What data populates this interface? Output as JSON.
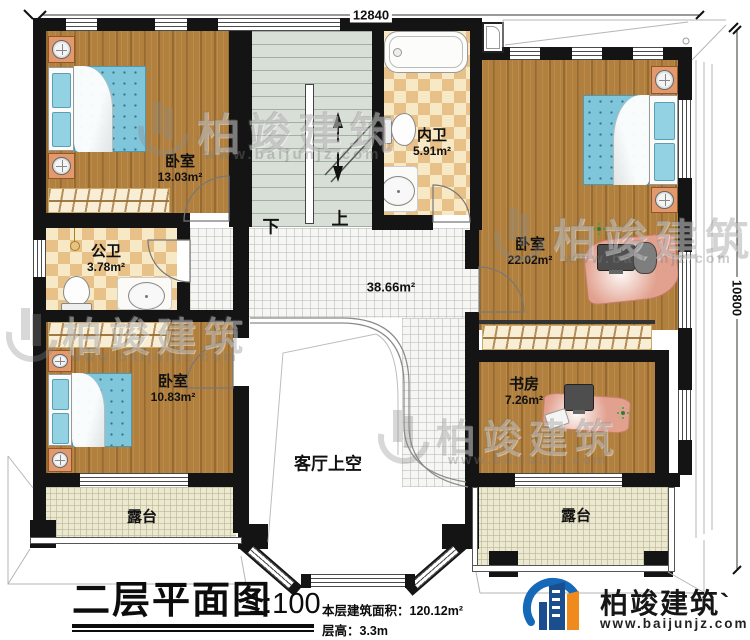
{
  "dimensions": {
    "top": "12840",
    "right": "10800"
  },
  "rooms": {
    "bedroom_tl": {
      "name": "卧室",
      "area": "13.03m²"
    },
    "public_bath": {
      "name": "公卫",
      "area": "3.78m²"
    },
    "bedroom_bl": {
      "name": "卧室",
      "area": "10.83m²"
    },
    "inner_bath": {
      "name": "内卫",
      "area": "5.91m²"
    },
    "bedroom_r": {
      "name": "卧室",
      "area": "22.02m²"
    },
    "study": {
      "name": "书房",
      "area": "7.26m²"
    },
    "hall": {
      "area": "38.66m²"
    },
    "void": {
      "name": "客厅上空"
    },
    "terrace_left": {
      "name": "露台"
    },
    "terrace_right": {
      "name": "露台"
    }
  },
  "stairs": {
    "down_label": "下",
    "up_label": "上"
  },
  "title_block": {
    "title": "二层平面图",
    "scale": "1:100",
    "area_line": "本层建筑面积：120.12m²",
    "height_line": "层高：3.3m"
  },
  "logo": {
    "name": "柏竣建筑`",
    "website": "www.baijunjz.com"
  },
  "watermark": {
    "name": "柏竣建筑",
    "website": "www.baijunjz.com"
  },
  "colors": {
    "wall": "#141414",
    "wood": "#b1803f",
    "checker_dark": "#e7c188",
    "checker_light": "#f7e9c6",
    "tile": "#f6f6f4",
    "terrace": "#ece9d2",
    "stairs": "#d8dfd6",
    "bed": "#7fc6da",
    "desk": "#e2a18f",
    "logo_blue": "#1668b8",
    "logo_orange": "#f08a1d"
  }
}
